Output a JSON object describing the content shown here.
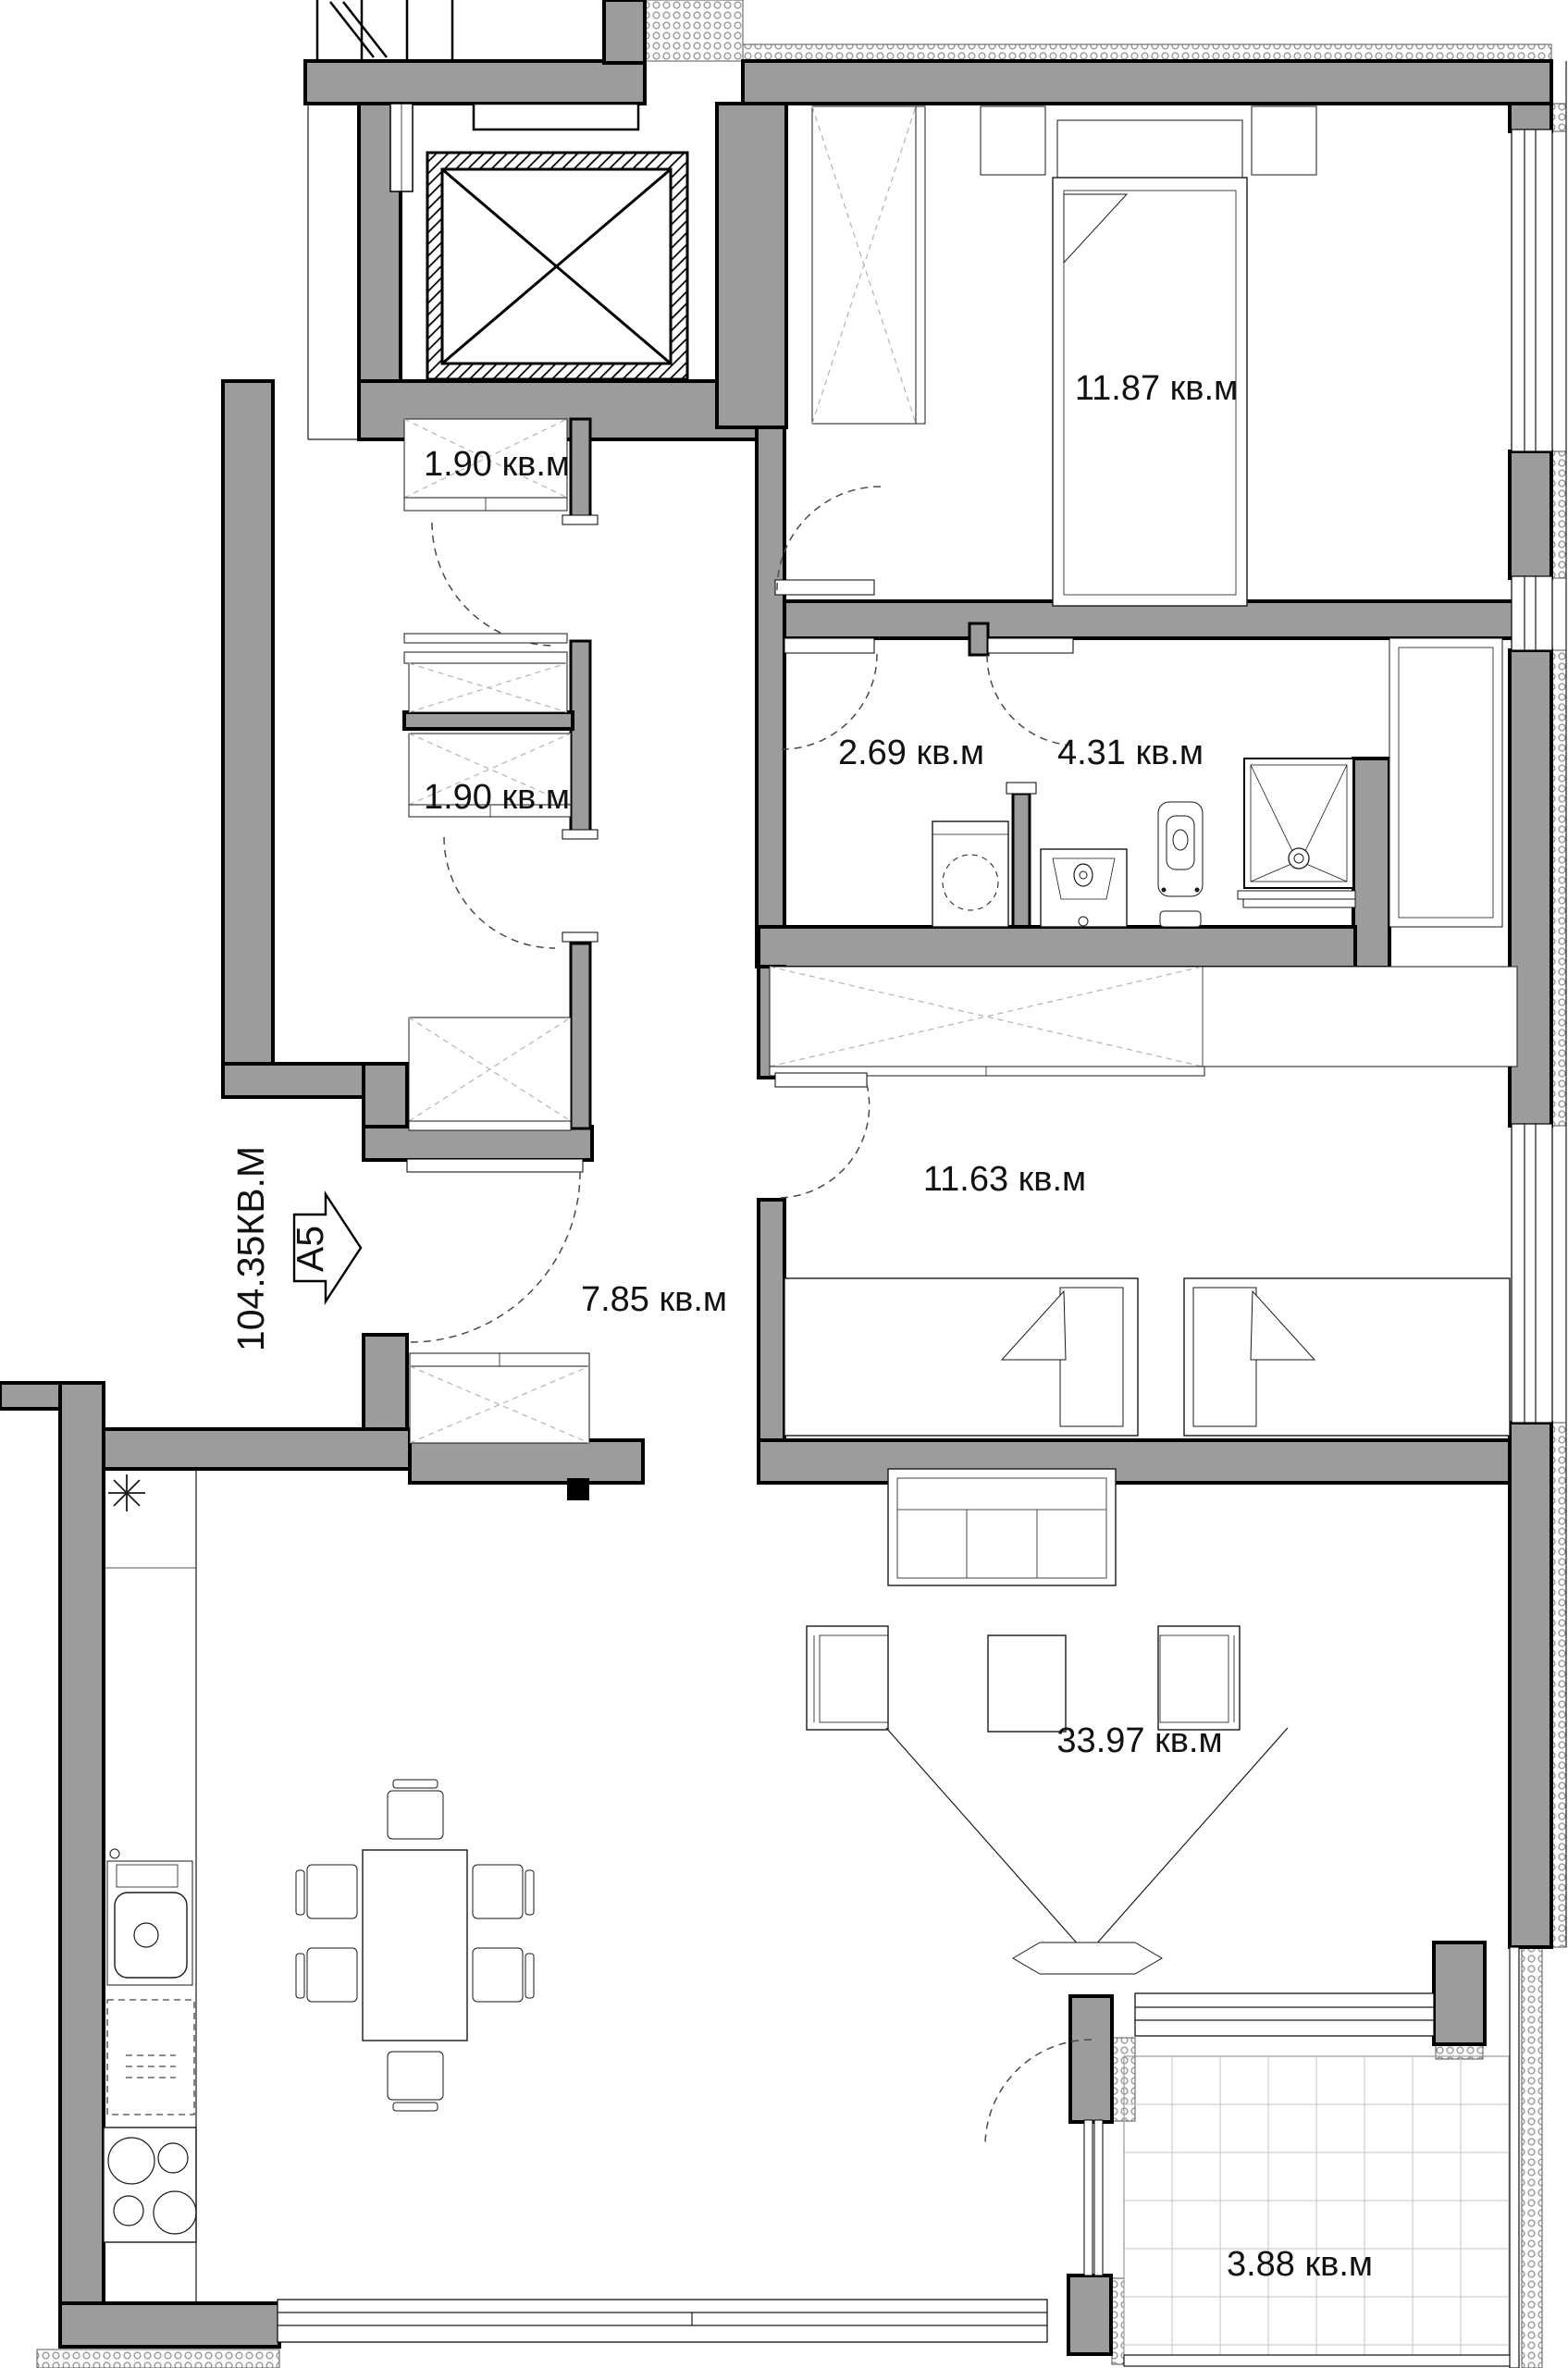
{
  "plan": {
    "unit_arrow_label": "A5",
    "total_area_label": "104.35КВ.М",
    "rooms": {
      "bedroom_main": {
        "label": "11.87 кв.м"
      },
      "storage_upper": {
        "label": "1.90 кв.м"
      },
      "storage_lower": {
        "label": "1.90 кв.м"
      },
      "laundry_corridor": {
        "label": "2.69 кв.м"
      },
      "bathroom": {
        "label": "4.31 кв.м"
      },
      "bedroom_second": {
        "label": "11.63 кв.м"
      },
      "hallway": {
        "label": "7.85 кв.м"
      },
      "living_room": {
        "label": "33.97 кв.м"
      },
      "balcony": {
        "label": "3.88 кв.м"
      }
    },
    "colors": {
      "wall": "#9c9c9c",
      "outline": "#000000",
      "background": "#ffffff",
      "furniture_line": "#1a1a1a"
    }
  }
}
